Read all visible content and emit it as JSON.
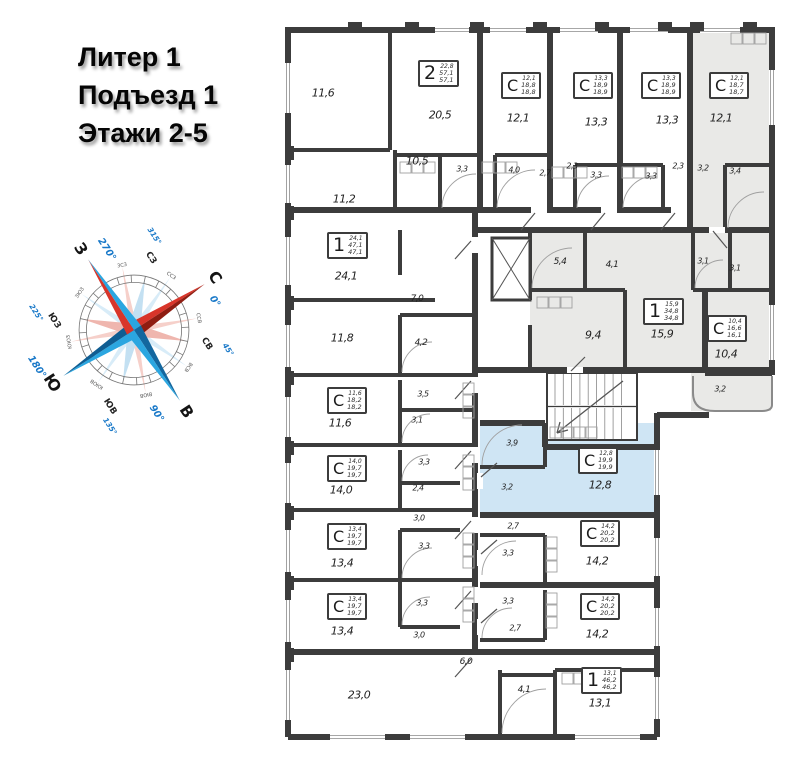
{
  "header": {
    "line1": "Литер 1",
    "line2": "Подъезд 1",
    "line3": "Этажи 2-5"
  },
  "compass": {
    "n": {
      "label": "С",
      "deg": "0°"
    },
    "e": {
      "label": "В",
      "deg": "90°"
    },
    "s": {
      "label": "Ю",
      "deg": "180°"
    },
    "w": {
      "label": "З",
      "deg": "270°"
    },
    "ne": {
      "label": "СВ",
      "deg": "45°"
    },
    "se": {
      "label": "ЮВ",
      "deg": "135°"
    },
    "sw": {
      "label": "ЮЗ",
      "deg": "225°"
    },
    "nw": {
      "label": "СЗ",
      "deg": "315°"
    },
    "minor": [
      "ССВ",
      "ВСВ",
      "ВЮВ",
      "ЮЮВ",
      "ЮЮЗ",
      "ЗЮЗ",
      "ЗСЗ",
      "ССЗ"
    ],
    "colors": {
      "red": "#d8352a",
      "dark_red": "#8f1d12",
      "blue": "#2ba6e0",
      "dark_blue": "#0f5d92",
      "degree_text": "#1878c8"
    }
  },
  "plan": {
    "colors": {
      "wall": "#3c3c3c",
      "gray_unit": "#e9e9e7",
      "blue_unit": "#cfe5f4"
    },
    "highlights": [
      [
        405,
        12,
        82,
        203,
        "gray",
        "studio-c-18-7",
        "true"
      ],
      [
        245,
        212,
        172,
        146,
        "gray",
        "apartment-1-34-8",
        "true"
      ],
      [
        417,
        212,
        70,
        146,
        "gray",
        "studio-c-16-6",
        "true"
      ],
      [
        406,
        358,
        80,
        38,
        "gray",
        "balcony-3-2",
        "false"
      ],
      [
        195,
        408,
        177,
        94,
        "blue",
        "studio-c-19-9-selected",
        "true"
      ]
    ],
    "units": [
      [
        "2",
        "22,8",
        "57,1",
        "57,1",
        133,
        45
      ],
      [
        "С",
        "12,1",
        "18,8",
        "18,8",
        216,
        57
      ],
      [
        "С",
        "13,3",
        "18,9",
        "18,9",
        288,
        57
      ],
      [
        "С",
        "13,3",
        "18,9",
        "18,9",
        356,
        57
      ],
      [
        "С",
        "12,1",
        "18,7",
        "18,7",
        424,
        57
      ],
      [
        "1",
        "24,1",
        "47,1",
        "47,1",
        42,
        217
      ],
      [
        "С",
        "11,6",
        "18,2",
        "18,2",
        42,
        372
      ],
      [
        "1",
        "15,9",
        "34,8",
        "34,8",
        358,
        283
      ],
      [
        "С",
        "10,4",
        "16,6",
        "16,1",
        422,
        300
      ],
      [
        "С",
        "14,0",
        "19,7",
        "19,7",
        42,
        440
      ],
      [
        "С",
        "12,8",
        "19,9",
        "19,9",
        293,
        432
      ],
      [
        "С",
        "13,4",
        "19,7",
        "19,7",
        42,
        508
      ],
      [
        "С",
        "13,4",
        "19,7",
        "19,7",
        42,
        578
      ],
      [
        "С",
        "14,2",
        "20,2",
        "20,2",
        295,
        505
      ],
      [
        "С",
        "14,2",
        "20,2",
        "20,2",
        295,
        578
      ],
      [
        "1",
        "13,1",
        "46,2",
        "46,2",
        296,
        652
      ]
    ],
    "labels": [
      [
        "11,6",
        38,
        78
      ],
      [
        "20,5",
        155,
        100
      ],
      [
        "12,1",
        233,
        103
      ],
      [
        "13,3",
        311,
        107
      ],
      [
        "13,3",
        382,
        105
      ],
      [
        "12,1",
        436,
        103
      ],
      [
        "11,2",
        59,
        184
      ],
      [
        "10,5",
        132,
        146
      ],
      [
        "3,3",
        177,
        154
      ],
      [
        "4,0",
        229,
        155
      ],
      [
        "2,7",
        260,
        158
      ],
      [
        "2,3",
        287,
        151
      ],
      [
        "3,3",
        311,
        160
      ],
      [
        "3,3",
        366,
        161
      ],
      [
        "2,3",
        393,
        151
      ],
      [
        "3,2",
        418,
        153
      ],
      [
        "3,4",
        450,
        156
      ],
      [
        "24,1",
        61,
        261
      ],
      [
        "7,0",
        132,
        284
      ],
      [
        "5,4",
        275,
        247
      ],
      [
        "4,1",
        327,
        250
      ],
      [
        "3,1",
        418,
        246
      ],
      [
        "3,1",
        450,
        253
      ],
      [
        "11,8",
        57,
        323
      ],
      [
        "4,2",
        136,
        328
      ],
      [
        "9,4",
        308,
        320
      ],
      [
        "15,9",
        377,
        319
      ],
      [
        "10,4",
        441,
        339
      ],
      [
        "3,5",
        138,
        379
      ],
      [
        "3,1",
        132,
        405
      ],
      [
        "11,6",
        55,
        408
      ],
      [
        "3,2",
        435,
        374
      ],
      [
        "3,9",
        227,
        428
      ],
      [
        "3,2",
        222,
        472
      ],
      [
        "12,8",
        315,
        470
      ],
      [
        "14,0",
        56,
        475
      ],
      [
        "3,3",
        139,
        447
      ],
      [
        "2,4",
        133,
        473
      ],
      [
        "3,0",
        134,
        503
      ],
      [
        "2,7",
        228,
        511
      ],
      [
        "3,3",
        223,
        538
      ],
      [
        "14,2",
        312,
        546
      ],
      [
        "13,4",
        57,
        548
      ],
      [
        "3,3",
        139,
        531
      ],
      [
        "3,3",
        137,
        588
      ],
      [
        "13,4",
        57,
        616
      ],
      [
        "3,0",
        134,
        620
      ],
      [
        "3,3",
        223,
        586
      ],
      [
        "2,7",
        230,
        613
      ],
      [
        "14,2",
        312,
        619
      ],
      [
        "6,0",
        181,
        647
      ],
      [
        "4,1",
        239,
        675
      ],
      [
        "23,0",
        74,
        680
      ],
      [
        "13,1",
        315,
        688
      ]
    ]
  }
}
